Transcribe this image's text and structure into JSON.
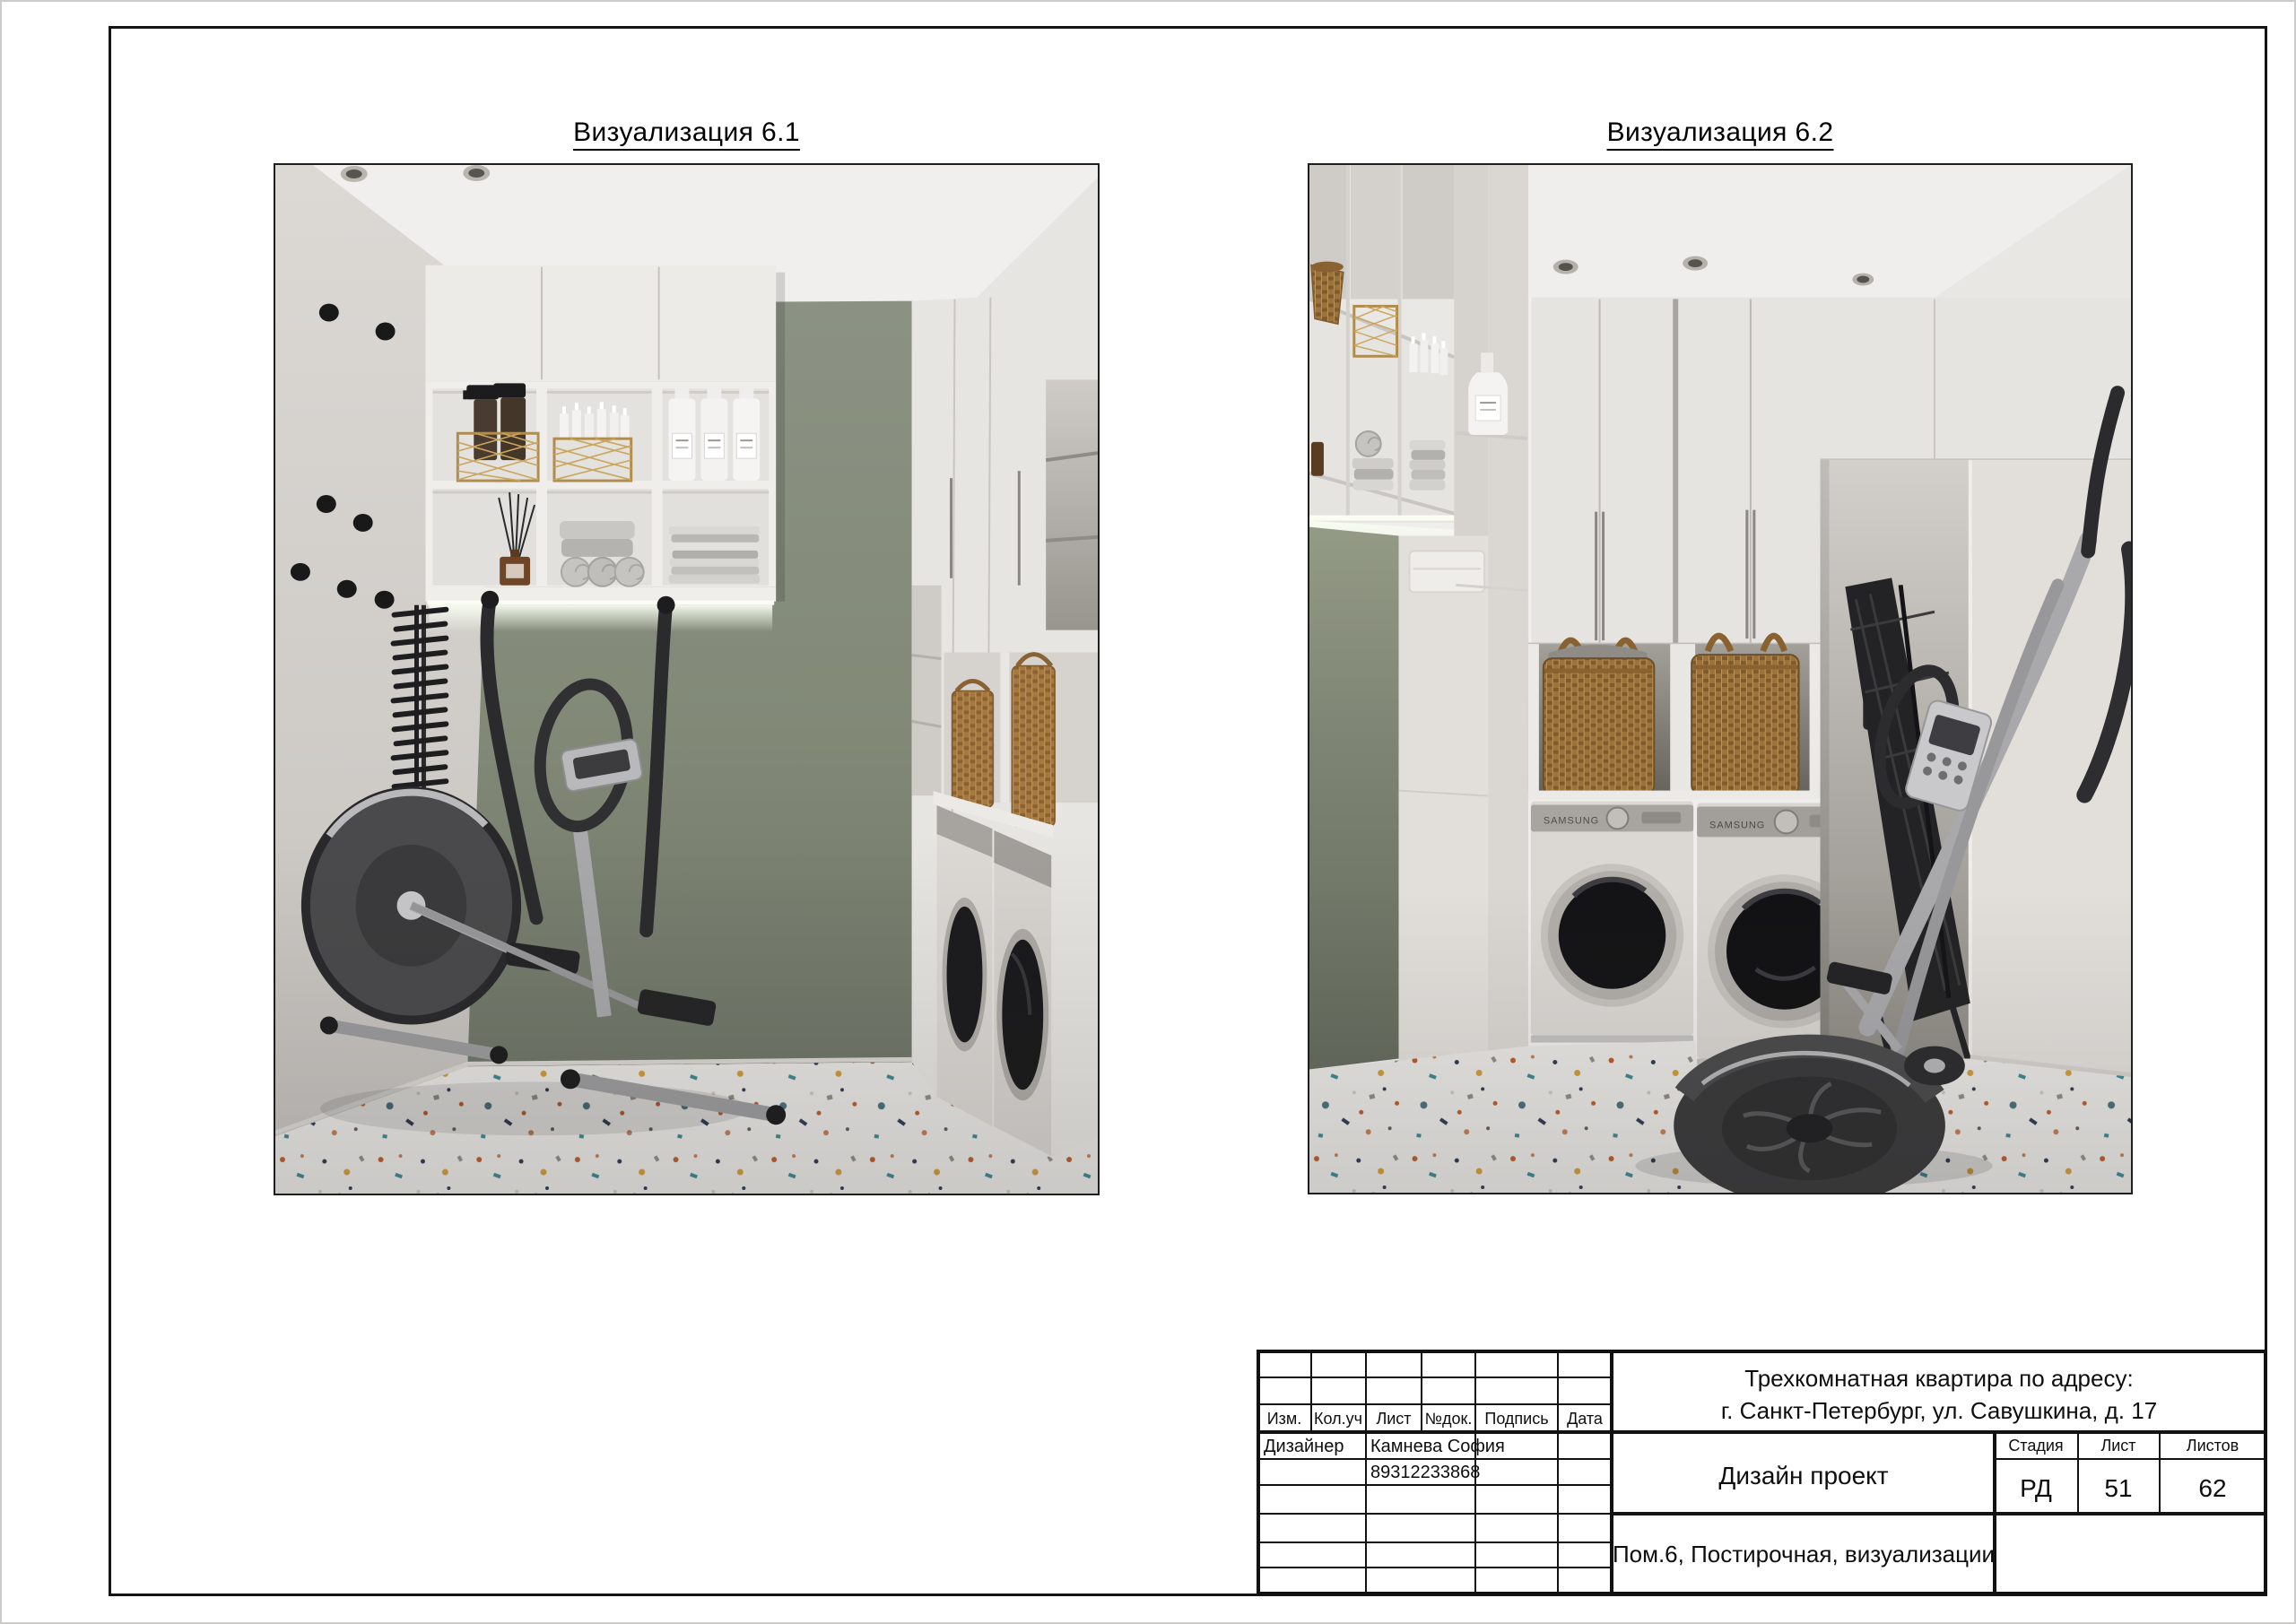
{
  "figures": [
    {
      "label": "Визуализация 6.1"
    },
    {
      "label": "Визуализация 6.2"
    }
  ],
  "brand": {
    "washer": "SAMSUNG"
  },
  "title_block": {
    "project": {
      "line1": "Трехкомнатная квартира по адресу:",
      "line2": "г. Санкт-Петербург, ул. Савушкина, д. 17"
    },
    "doc_type": "Дизайн проект",
    "sheet_content": "Пом.6, Постирочная, визуализации",
    "columns": {
      "izm": "Изм.",
      "kol_uch": "Кол.уч",
      "list": "Лист",
      "ndok": "№док.",
      "podpis": "Подпись",
      "data": "Дата"
    },
    "designer": {
      "role": "Дизайнер",
      "name": "Камнева София",
      "phone": "89312233868"
    },
    "stage": {
      "label": "Стадия",
      "value": "РД"
    },
    "sheet": {
      "label": "Лист",
      "value": "51"
    },
    "sheets": {
      "label": "Листов",
      "value": "62"
    }
  },
  "colors": {
    "accent_green_wall": "#858c7f",
    "frame_line": "#151515",
    "gold_basket": "#b08c4f",
    "terrazzo_base": "#e9e7e4"
  }
}
